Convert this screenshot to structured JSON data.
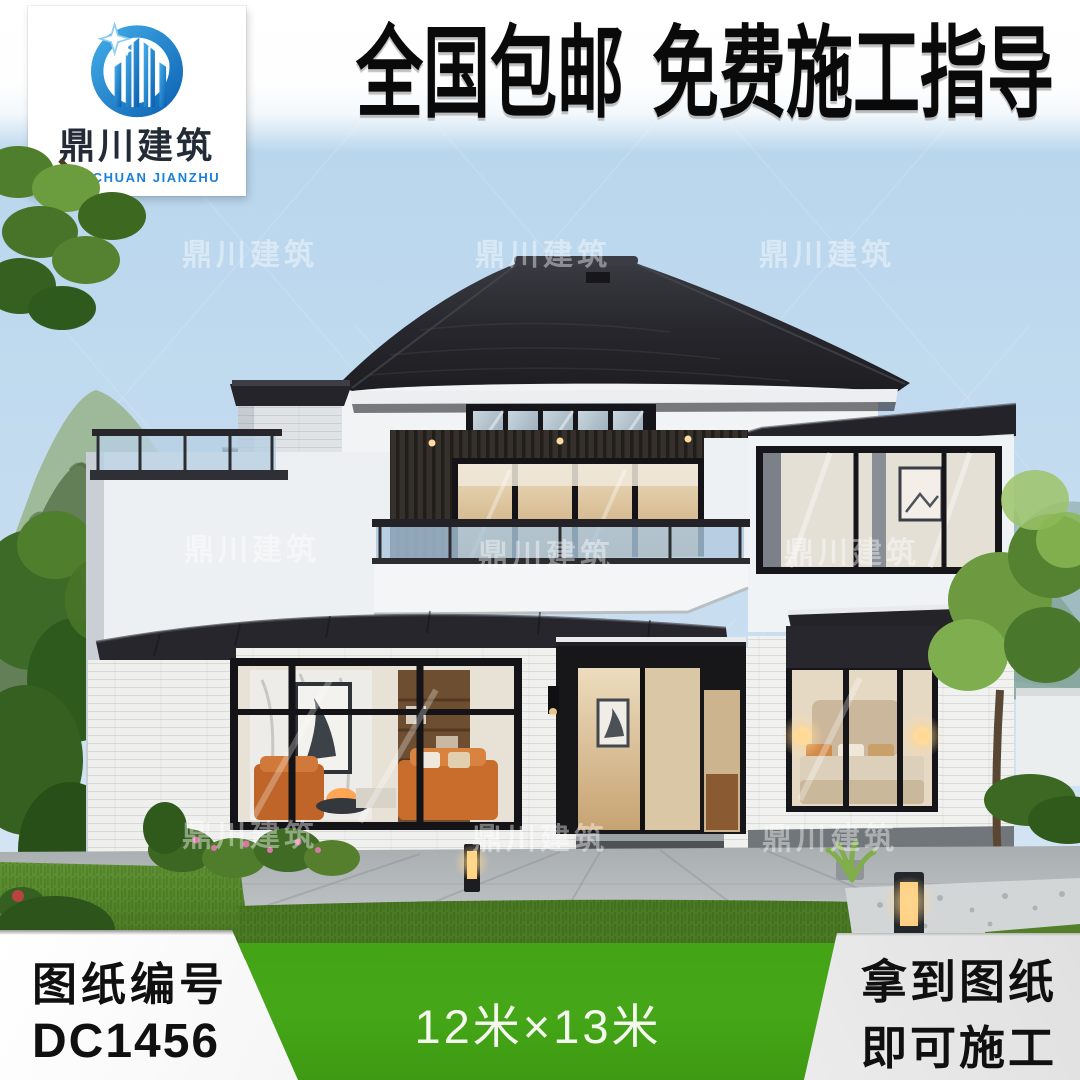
{
  "logo": {
    "company_zh": "鼎川建筑",
    "company_en": "DINGCHUAN JIANZHU"
  },
  "banner": {
    "headline": "全国包邮 免费施工指导"
  },
  "watermark": {
    "text": "鼎川建筑",
    "positions": [
      [
        250,
        252
      ],
      [
        543,
        252
      ],
      [
        827,
        252
      ],
      [
        252,
        547
      ],
      [
        546,
        552
      ],
      [
        852,
        550
      ],
      [
        250,
        833
      ],
      [
        540,
        836
      ],
      [
        830,
        836
      ]
    ]
  },
  "footer": {
    "left": {
      "label": "图纸编号",
      "code": "DC1456"
    },
    "center": {
      "size": "12米×13米"
    },
    "right": {
      "line1": "拿到图纸",
      "line2": "即可施工"
    }
  },
  "colors": {
    "accent_green": "#43a316",
    "logo_blue": "#1b80d8",
    "banner_text": "#0a0a0a",
    "roof_dark": "#26262b",
    "sky_blue": "#b5d4ec"
  }
}
